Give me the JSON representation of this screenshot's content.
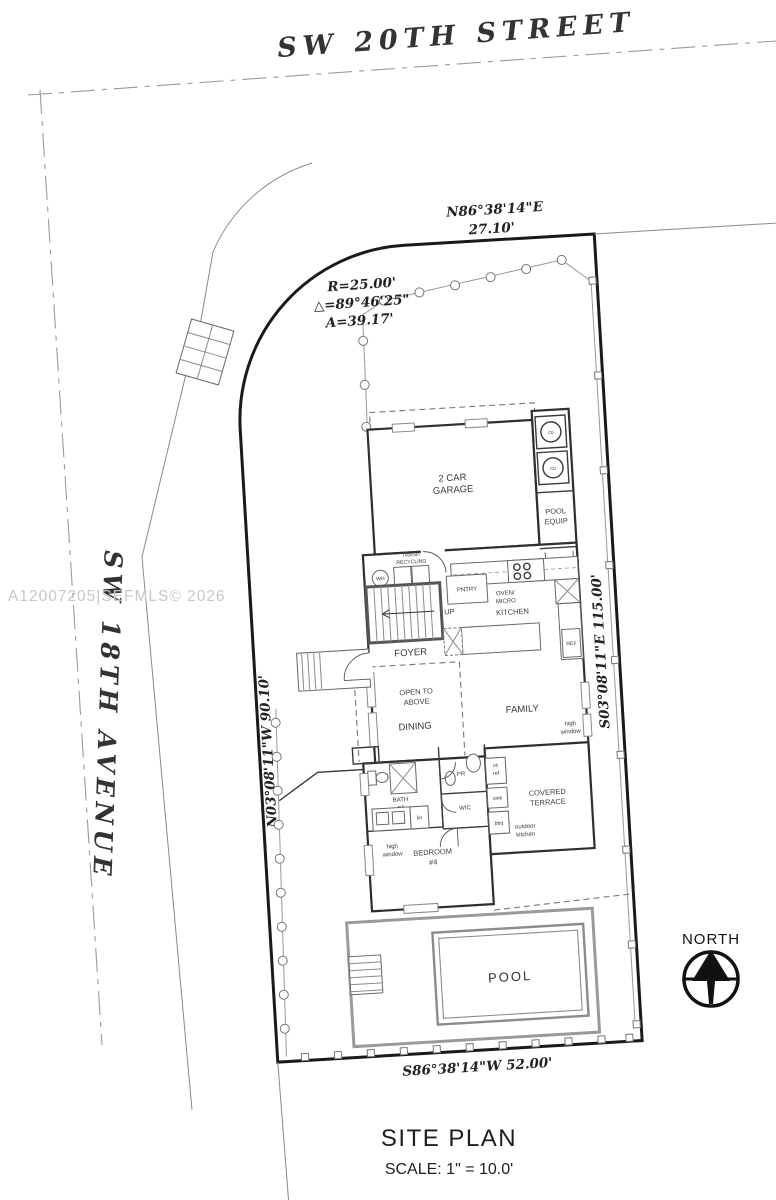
{
  "watermark": "A12007205|SEFMLS© 2026",
  "colors": {
    "boundary": "#1a1a1a",
    "walls": "#2f2f2f",
    "thin_lines": "#8a8a8a",
    "watermark": "#c7c7c7"
  },
  "streets": {
    "top": "SW 20TH STREET",
    "left": "SW 18TH AVENUE"
  },
  "survey": {
    "north_bearing": "N86°38'14\"E",
    "north_distance": "27.10'",
    "curve_radius": "R=25.00'",
    "curve_delta": "△=89°46'25\"",
    "curve_arc": "A=39.17'",
    "east_bearing": "S03°08'11\"E  115.00'",
    "west_bearing": "N03°08'11\"W  90.10'",
    "south_bearing": "S86°38'14\"W  52.00'"
  },
  "rooms": {
    "garage1": "2 CAR",
    "garage2": "GARAGE",
    "pool_equip1": "POOL",
    "pool_equip2": "EQUIP",
    "trash1": "TRASH",
    "trash2": "RECYCLING",
    "pantry": "PNTRY",
    "oven1": "OVEN/",
    "oven2": "MICRO",
    "kitchen": "KITCHEN",
    "foyer": "FOYER",
    "open1": "OPEN TO",
    "open2": "ABOVE",
    "dining": "DINING",
    "family": "FAMILY",
    "hw1": "high",
    "hw2": "window",
    "bath1": "BATH",
    "bath2": "#4",
    "bedroom1": "BEDROOM",
    "bedroom2": "#4",
    "terrace1": "COVERED",
    "terrace2": "TERRACE",
    "outdoor1": "outdoor",
    "outdoor2": "kitchen",
    "pool": "POOL"
  },
  "fixtures": {
    "wh": "WH",
    "cu": "cu",
    "up": "UP",
    "ref": "REF",
    "lin": "lin",
    "pr": "PR",
    "wic": "WIC",
    "uc": "uc",
    "ucref": "ref",
    "sink": "sink",
    "bbq": "bbq"
  },
  "compass": {
    "label": "NORTH"
  },
  "title_block": {
    "title": "SITE PLAN",
    "scale": "SCALE: 1\" = 10.0'"
  }
}
